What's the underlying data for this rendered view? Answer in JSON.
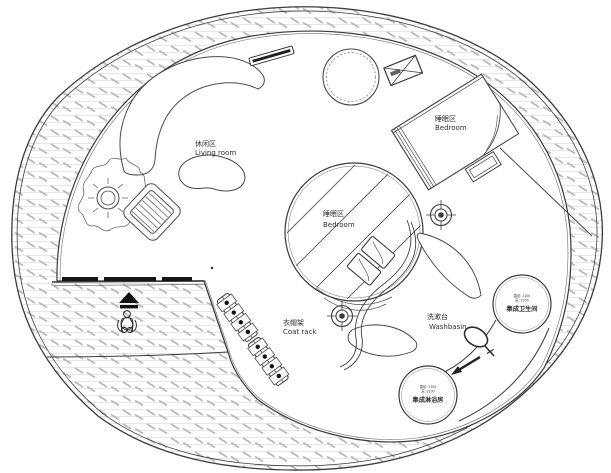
{
  "plan": {
    "type": "circular-tiny-house-floor-plan",
    "colors": {
      "line": "#3b3b3b",
      "furniture_line": "#4a4a4a",
      "hatch_line": "#dedede",
      "hatch_dash": "#b9b9b9",
      "dark_fill": "#161616",
      "background": "#ffffff",
      "text": "#2f2f2f"
    },
    "areas": {
      "living_room": {
        "label_zh": "休闲区",
        "label_en": "Living room"
      },
      "bedroom_upper": {
        "label_zh": "睡眠区",
        "label_en": "Bedroom"
      },
      "bedroom_center": {
        "label_zh": "睡眠区",
        "label_en": "Bedroom"
      },
      "coat_rack": {
        "label_zh": "衣帽架",
        "label_en": "Coat rack"
      },
      "washbasin": {
        "label_zh": "洗漱台",
        "label_en": "Washbasin"
      }
    },
    "pods": {
      "bathroom": {
        "name": "集成卫生间",
        "spec1": "直径: 1100",
        "spec2": "高: 2100"
      },
      "shower": {
        "name": "集成淋浴房",
        "spec1": "直径: 1100",
        "spec2": "高: 2100"
      }
    }
  }
}
